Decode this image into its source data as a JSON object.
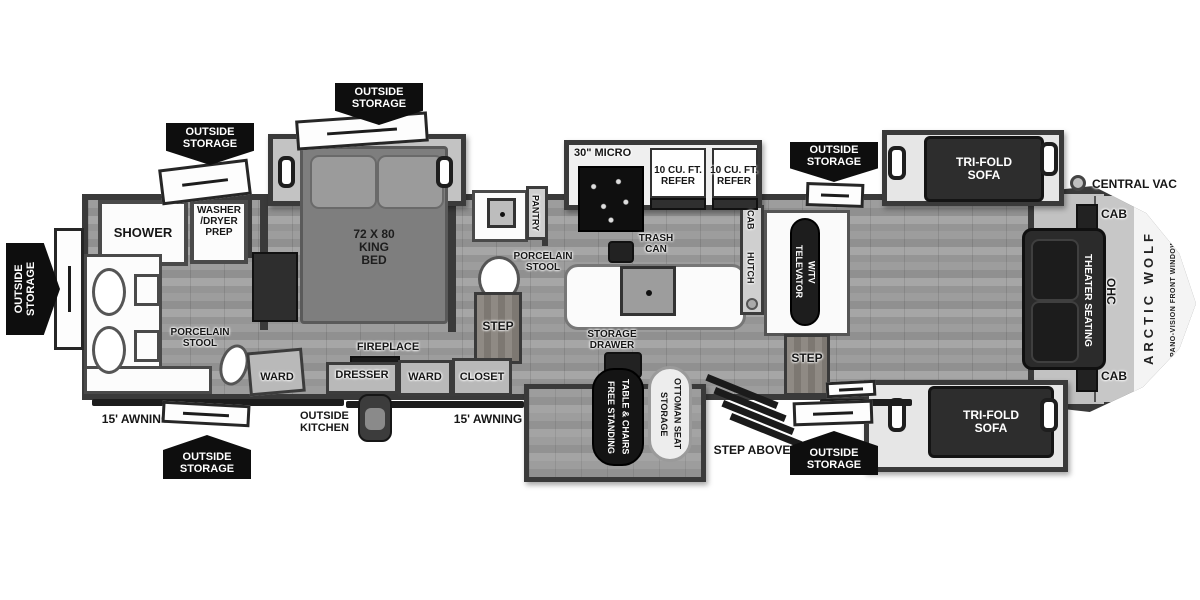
{
  "title": "Arctic Wolf fifth wheel RV floor plan",
  "colors": {
    "wall": "#3a3a3a",
    "badge_bg": "#0e0e0e",
    "floor_mid": "#979797",
    "sofa_dark": "#2d2d2d",
    "fixture_white": "#ffffff"
  },
  "labels": {
    "outside_storage": "OUTSIDE\nSTORAGE",
    "shower": "SHOWER",
    "washer_dryer_prep": "WASHER\n/DRYER\nPREP",
    "porcelain_stool": "PORCELAIN\nSTOOL",
    "ward": "WARD",
    "king_bed": "72 X 80\nKING\nBED",
    "dresser": "DRESSER",
    "fireplace": "FIREPLACE",
    "closet": "CLOSET",
    "step": "STEP",
    "pantry": "PANTRY",
    "micro": "30\" MICRO",
    "refer": "10 CU. FT.\nREFER",
    "trash_can": "TRASH\nCAN",
    "storage_drawer": "STORAGE\nDRAWER",
    "cab": "CAB",
    "hutch": "HUTCH",
    "televator": "TELEVATOR\nW/TV",
    "free_standing_table": "FREE STANDING\nTABLE & CHAIRS",
    "storage_ottoman": "STORAGE\nOTTOMAN SEAT",
    "step_above": "STEP ABOVE",
    "outside_kitchen": "OUTSIDE\nKITCHEN",
    "awning_15": "15' AWNING",
    "tri_fold_sofa": "TRI-FOLD\nSOFA",
    "theater_seating": "THEATER SEATING",
    "ohc": "OHC",
    "central_vac": "CENTRAL VAC",
    "arctic_wolf": "ARCTIC WOLF",
    "pano_vision": "PANO-VISION FRONT WINDOW"
  }
}
